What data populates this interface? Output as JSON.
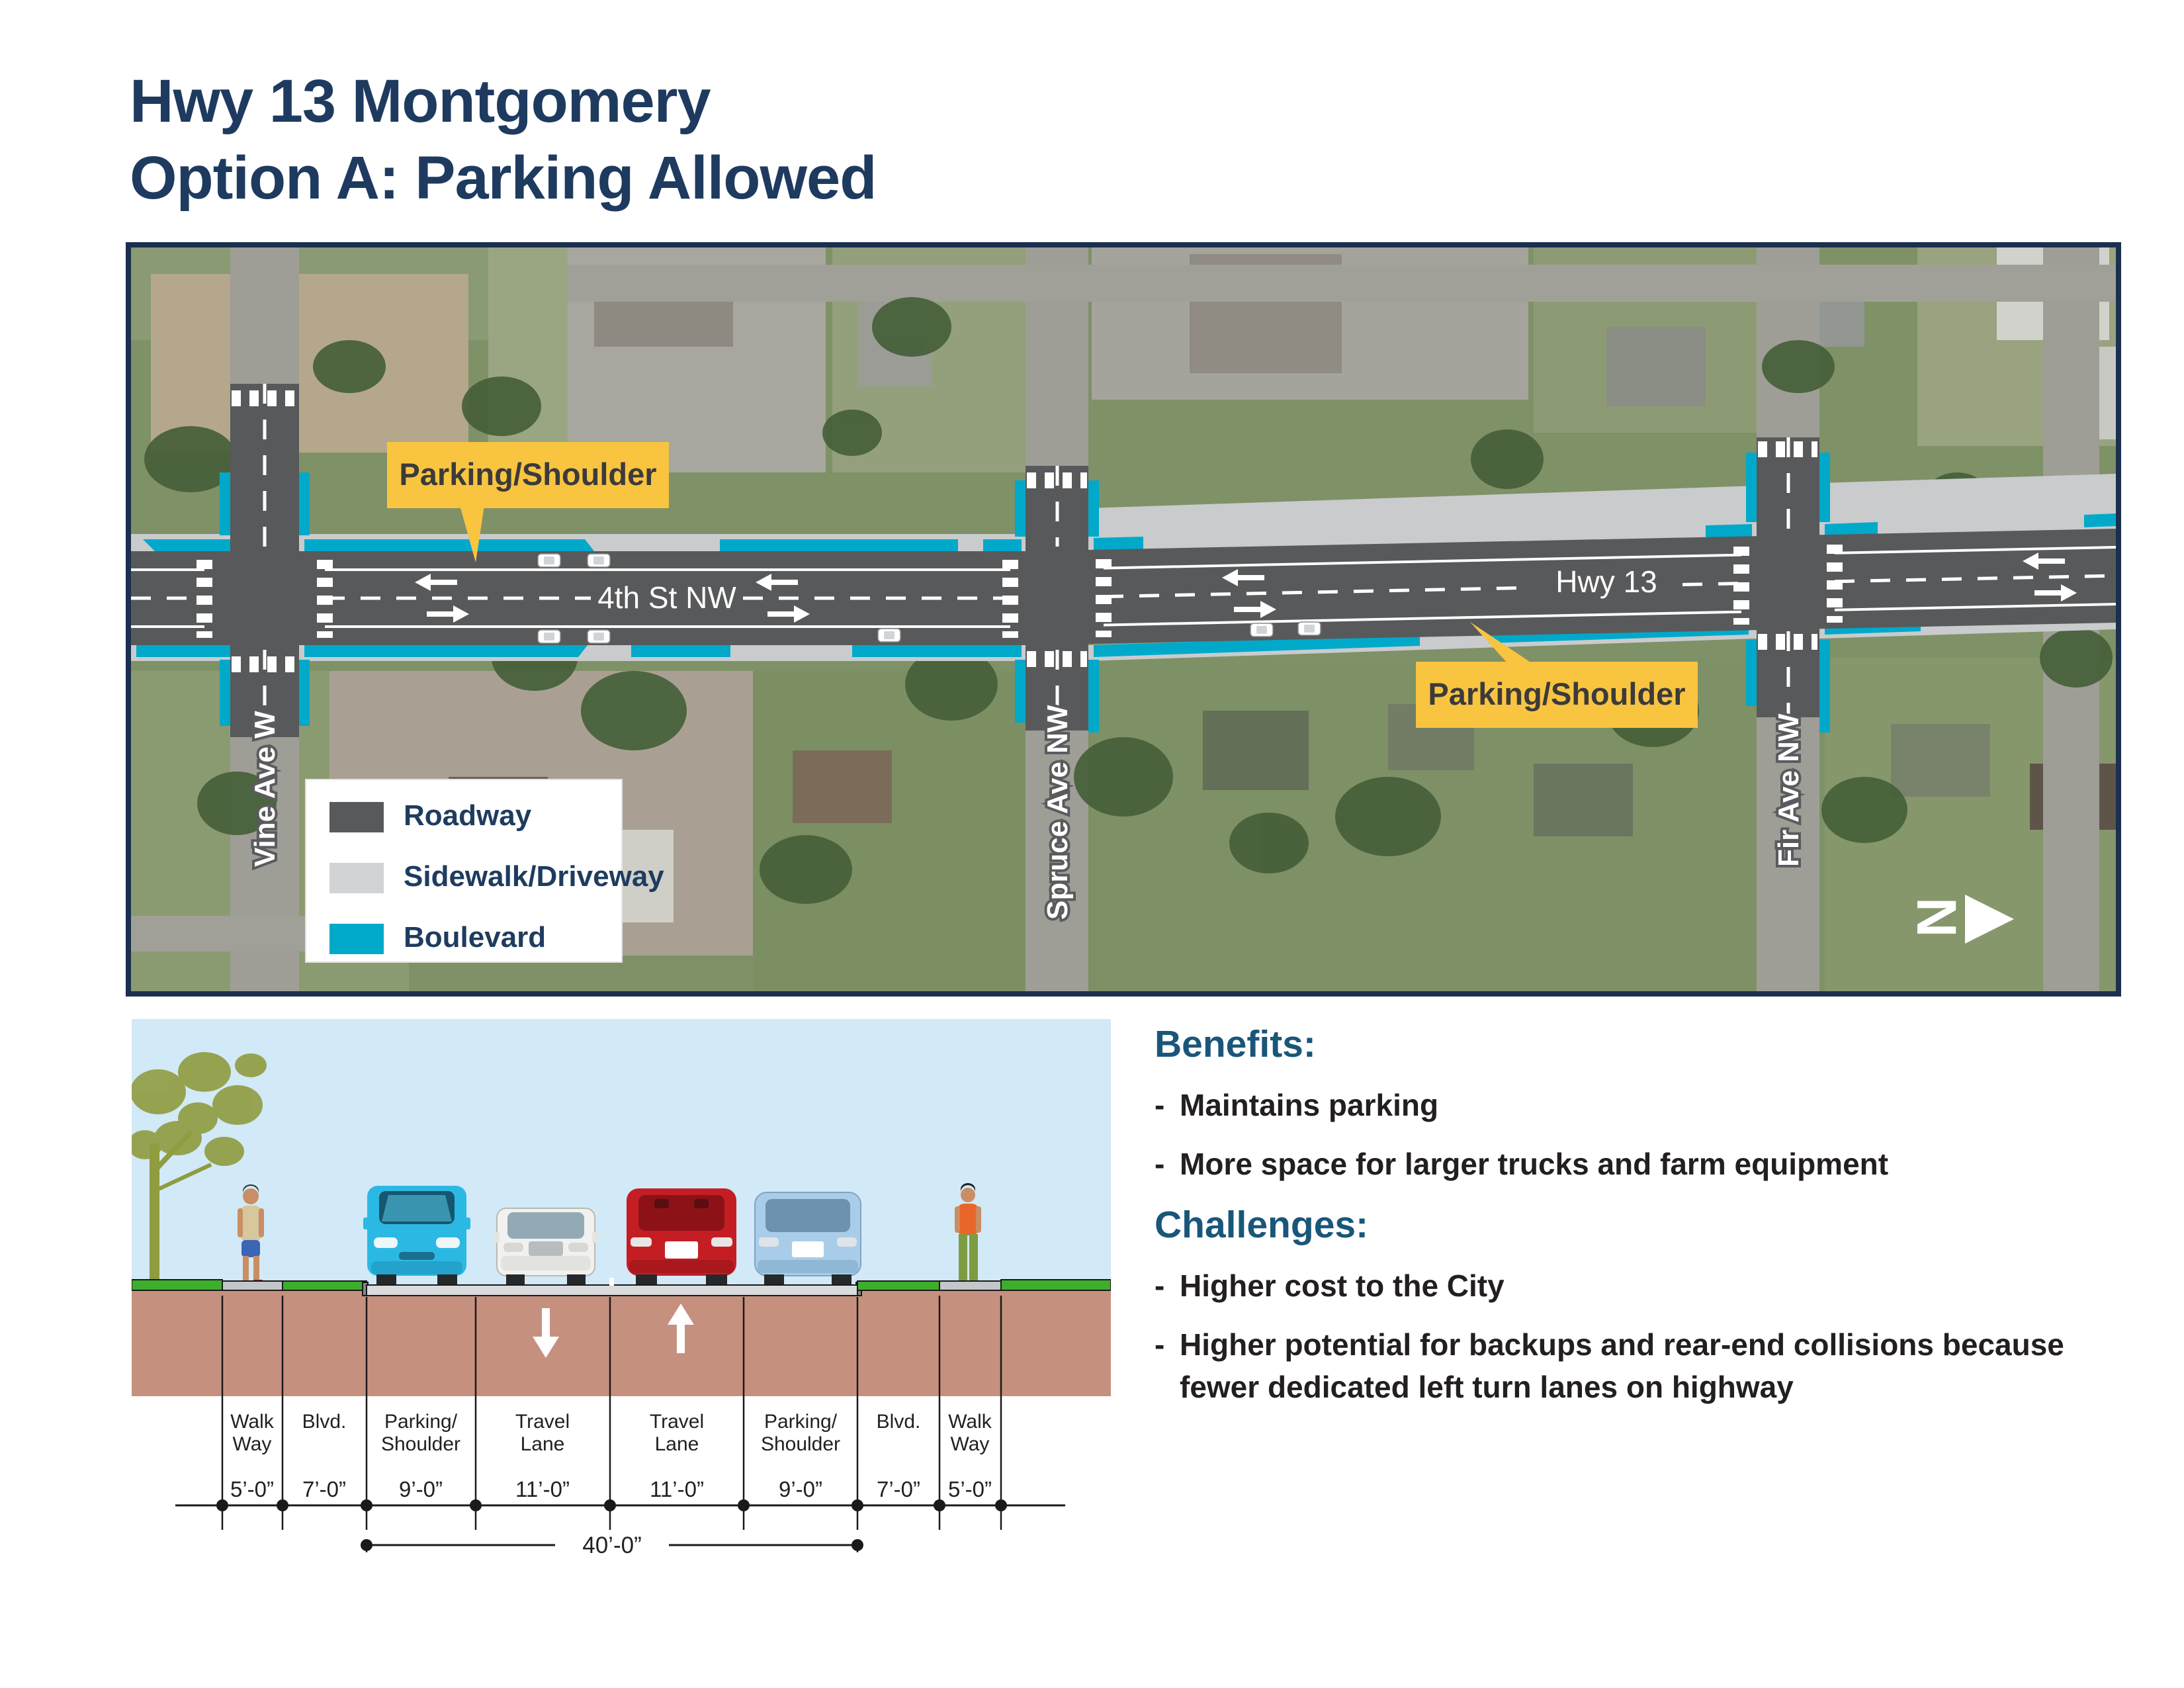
{
  "title": {
    "line1": "Hwy 13 Montgomery",
    "line2": "Option A: Parking Allowed"
  },
  "map": {
    "road_labels": {
      "left": "4th St NW",
      "right": "Hwy 13"
    },
    "cross_streets": {
      "vine": "Vine Ave W",
      "spruce": "Spruce Ave NW",
      "fir": "Fir Ave NW"
    },
    "callout_top": "Parking/Shoulder",
    "callout_bottom": "Parking/Shoulder",
    "legend": {
      "roadway": "Roadway",
      "sidewalk": "Sidewalk/Driveway",
      "boulevard": "Boulevard"
    },
    "north": "N"
  },
  "cross_section": {
    "lanes": [
      {
        "line1": "Walk",
        "line2": "Way",
        "width": "5’-0”"
      },
      {
        "line1": "Blvd.",
        "line2": "",
        "width": "7’-0”"
      },
      {
        "line1": "Parking/",
        "line2": "Shoulder",
        "width": "9’-0”"
      },
      {
        "line1": "Travel",
        "line2": "Lane",
        "width": "11’-0”"
      },
      {
        "line1": "Travel",
        "line2": "Lane",
        "width": "11’-0”"
      },
      {
        "line1": "Parking/",
        "line2": "Shoulder",
        "width": "9’-0”"
      },
      {
        "line1": "Blvd.",
        "line2": "",
        "width": "7’-0”"
      },
      {
        "line1": "Walk",
        "line2": "Way",
        "width": "5’-0”"
      }
    ],
    "total_width": "40’-0”"
  },
  "benefits": {
    "heading": "Benefits:",
    "items": [
      {
        "lines": [
          "Maintains parking"
        ]
      },
      {
        "lines": [
          "More space for larger trucks and farm equipment"
        ]
      }
    ]
  },
  "challenges": {
    "heading": "Challenges:",
    "items": [
      {
        "lines": [
          "Higher cost to the City"
        ]
      },
      {
        "lines": [
          "Higher potential for backups and rear-end collisions because",
          "fewer dedicated left turn lanes on highway"
        ]
      }
    ]
  },
  "bullet": "-",
  "colors": {
    "accent_navy": "#1e3a5f",
    "accent_teal": "#19567a",
    "roadway": "#58595b",
    "sidewalk": "#c9cbcd",
    "boulevard": "#00a9c9",
    "callout": "#f9c440",
    "earth": "#c6907f",
    "sky": "#d2e9f7",
    "grass": "#3dae2b"
  }
}
